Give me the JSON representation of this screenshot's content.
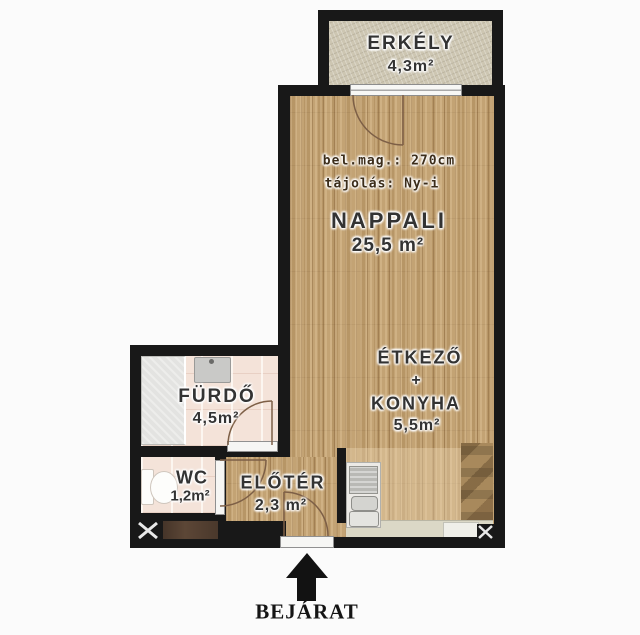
{
  "rooms": {
    "erkely": {
      "name": "ERKÉLY",
      "area": "4,3m²"
    },
    "nappali": {
      "name": "NAPPALI",
      "area": "25,5 m²"
    },
    "etkezo": {
      "line1": "ÉTKEZŐ",
      "line2": "+",
      "line3": "KONYHA",
      "area": "5,5m²"
    },
    "furdo": {
      "name": "FÜRDŐ",
      "area": "4,5m²"
    },
    "wc": {
      "name": "WC",
      "area": "1,2m²"
    },
    "eloter": {
      "name": "ELŐTÉR",
      "area": "2,3 m²"
    }
  },
  "annotations": {
    "ceiling_height": "bel.mag.: 270cm",
    "orientation": "tájolás: Ny-i"
  },
  "entrance": {
    "label": "BEJÁRAT"
  },
  "icons": {
    "entrance_arrow": "up-arrow",
    "shaft_left": "x-box",
    "shaft_right": "x-box"
  },
  "colors": {
    "wall": "#181818",
    "wood_floor": "#bfa072",
    "balcony_floor": "#cdc6b2",
    "bathroom_tile": "#f4e3d9",
    "counter": "#dbd8c6",
    "cabinet": "#a8895c",
    "dark_cabinet": "#5c4636",
    "background": "#fbfbfb"
  }
}
